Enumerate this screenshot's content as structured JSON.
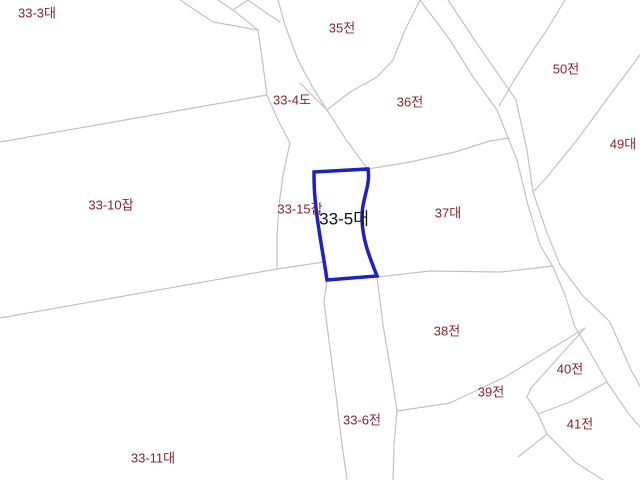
{
  "map": {
    "type": "cadastral-parcel-map",
    "canvas": {
      "width": 640,
      "height": 480
    },
    "colors": {
      "background": "#ffffff",
      "boundary_line": "#c2c2c2",
      "label_text": "#8a212e",
      "highlight_label_text": "#111111",
      "highlight_outline": "#1a1fd0"
    },
    "selected_parcel": {
      "label": "33-5대",
      "outline_path": "M 314 172 L 368 169 C 371 186 361 200 362 220 C 363 243 371 260 377 276 L 327 280 C 323 252 317 224 315 198 C 314 188 314 179 314 172 Z",
      "outline_width": 3.5
    },
    "labels": [
      {
        "id": "parcel-label-33-3",
        "text": "33-3대",
        "x": 37,
        "y": 12,
        "highlight": false
      },
      {
        "id": "parcel-label-35",
        "text": "35전",
        "x": 342,
        "y": 27,
        "highlight": false
      },
      {
        "id": "parcel-label-33-4",
        "text": "33-4도",
        "x": 292,
        "y": 99,
        "highlight": false
      },
      {
        "id": "parcel-label-36",
        "text": "36전",
        "x": 410,
        "y": 101,
        "highlight": false
      },
      {
        "id": "parcel-label-50",
        "text": "50전",
        "x": 566,
        "y": 68,
        "highlight": false
      },
      {
        "id": "parcel-label-49",
        "text": "49대",
        "x": 623,
        "y": 143,
        "highlight": false
      },
      {
        "id": "parcel-label-33-10",
        "text": "33-10잡",
        "x": 111,
        "y": 204,
        "highlight": false
      },
      {
        "id": "parcel-label-33-15",
        "text": "33-15잡",
        "x": 300,
        "y": 208,
        "highlight": false
      },
      {
        "id": "parcel-label-33-5",
        "text": "33-5대",
        "x": 344,
        "y": 217,
        "highlight": true
      },
      {
        "id": "parcel-label-37",
        "text": "37대",
        "x": 448,
        "y": 212,
        "highlight": false
      },
      {
        "id": "parcel-label-38",
        "text": "38전",
        "x": 447,
        "y": 330,
        "highlight": false
      },
      {
        "id": "parcel-label-39",
        "text": "39전",
        "x": 491,
        "y": 391,
        "highlight": false
      },
      {
        "id": "parcel-label-40",
        "text": "40전",
        "x": 570,
        "y": 368,
        "highlight": false
      },
      {
        "id": "parcel-label-41",
        "text": "41전",
        "x": 580,
        "y": 423,
        "highlight": false
      },
      {
        "id": "parcel-label-33-6",
        "text": "33-6전",
        "x": 362,
        "y": 419,
        "highlight": false
      },
      {
        "id": "parcel-label-33-11",
        "text": "33-11대",
        "x": 153,
        "y": 457,
        "highlight": false
      }
    ],
    "boundary_lines": [
      {
        "name": "topleft-branch",
        "points": [
          [
            180,
            0
          ],
          [
            213,
            22
          ],
          [
            258,
            30
          ]
        ]
      },
      {
        "name": "top-notch-v",
        "points": [
          [
            218,
            0
          ],
          [
            233,
            10
          ],
          [
            248,
            0
          ]
        ]
      },
      {
        "name": "top-notch-link",
        "points": [
          [
            233,
            10
          ],
          [
            258,
            30
          ]
        ]
      },
      {
        "name": "top-merge-link",
        "points": [
          [
            248,
            0
          ],
          [
            265,
            12
          ],
          [
            280,
            22
          ]
        ]
      },
      {
        "name": "road1-left-upper",
        "points": [
          [
            258,
            30
          ],
          [
            263,
            65
          ],
          [
            267,
            95
          ],
          [
            278,
            120
          ],
          [
            290,
            143
          ]
        ]
      },
      {
        "name": "road1-left-mid",
        "points": [
          [
            290,
            143
          ],
          [
            283,
            175
          ],
          [
            279,
            205
          ],
          [
            277,
            235
          ],
          [
            277,
            269
          ]
        ]
      },
      {
        "name": "west-long-upper",
        "points": [
          [
            0,
            142
          ],
          [
            267,
            95
          ]
        ]
      },
      {
        "name": "west-long-lower",
        "points": [
          [
            0,
            318
          ],
          [
            277,
            269
          ],
          [
            324,
            262
          ]
        ]
      },
      {
        "name": "road1-right-upper",
        "points": [
          [
            278,
            0
          ],
          [
            285,
            25
          ],
          [
            298,
            60
          ],
          [
            313,
            88
          ],
          [
            327,
            110
          ]
        ]
      },
      {
        "name": "road1-right-spur",
        "points": [
          [
            300,
            83
          ],
          [
            327,
            110
          ]
        ]
      },
      {
        "name": "road1-right-mid",
        "points": [
          [
            327,
            110
          ],
          [
            345,
            138
          ],
          [
            363,
            163
          ],
          [
            368,
            169
          ]
        ]
      },
      {
        "name": "b35-36",
        "points": [
          [
            420,
            0
          ],
          [
            405,
            30
          ],
          [
            393,
            60
          ],
          [
            377,
            77
          ],
          [
            350,
            92
          ],
          [
            327,
            110
          ]
        ]
      },
      {
        "name": "b36-37",
        "points": [
          [
            368,
            169
          ],
          [
            410,
            162
          ],
          [
            455,
            152
          ],
          [
            490,
            141
          ],
          [
            509,
            138
          ]
        ]
      },
      {
        "name": "road1-left-lower",
        "points": [
          [
            327,
            280
          ],
          [
            324,
            302
          ],
          [
            329,
            340
          ],
          [
            336,
            395
          ],
          [
            341,
            437
          ],
          [
            347,
            480
          ]
        ]
      },
      {
        "name": "road1-right-lower",
        "points": [
          [
            377,
            277
          ],
          [
            383,
            325
          ],
          [
            391,
            372
          ],
          [
            397,
            411
          ],
          [
            394,
            445
          ],
          [
            393,
            480
          ]
        ]
      },
      {
        "name": "b37-38",
        "points": [
          [
            377,
            277
          ],
          [
            430,
            271
          ],
          [
            501,
            272
          ],
          [
            553,
            266
          ]
        ]
      },
      {
        "name": "b38-39",
        "points": [
          [
            397,
            411
          ],
          [
            450,
            403
          ],
          [
            505,
            377
          ],
          [
            585,
            328
          ]
        ]
      },
      {
        "name": "b40-west",
        "points": [
          [
            585,
            328
          ],
          [
            531,
            388
          ],
          [
            527,
            397
          ],
          [
            538,
            414
          ]
        ]
      },
      {
        "name": "b40-41",
        "points": [
          [
            538,
            414
          ],
          [
            570,
            402
          ],
          [
            607,
            382
          ]
        ]
      },
      {
        "name": "b41-south",
        "points": [
          [
            538,
            414
          ],
          [
            547,
            434
          ],
          [
            575,
            462
          ],
          [
            603,
            480
          ]
        ]
      },
      {
        "name": "b41-southwest",
        "points": [
          [
            547,
            434
          ],
          [
            518,
            457
          ]
        ]
      },
      {
        "name": "road2-left",
        "points": [
          [
            420,
            0
          ],
          [
            450,
            40
          ],
          [
            473,
            77
          ],
          [
            497,
            110
          ],
          [
            517,
            160
          ],
          [
            528,
            205
          ],
          [
            540,
            245
          ],
          [
            553,
            267
          ],
          [
            565,
            295
          ],
          [
            575,
            327
          ],
          [
            590,
            352
          ],
          [
            607,
            382
          ],
          [
            628,
            413
          ],
          [
            640,
            427
          ]
        ]
      },
      {
        "name": "road2-right",
        "points": [
          [
            448,
            0
          ],
          [
            478,
            45
          ],
          [
            516,
            100
          ],
          [
            527,
            150
          ],
          [
            533,
            192
          ],
          [
            546,
            230
          ],
          [
            560,
            265
          ],
          [
            582,
            295
          ],
          [
            610,
            322
          ],
          [
            631,
            370
          ],
          [
            640,
            386
          ]
        ]
      },
      {
        "name": "b35-50",
        "points": [
          [
            565,
            0
          ],
          [
            548,
            28
          ],
          [
            530,
            55
          ],
          [
            513,
            82
          ],
          [
            499,
            106
          ]
        ]
      },
      {
        "name": "b50-49",
        "points": [
          [
            640,
            55
          ],
          [
            610,
            95
          ],
          [
            577,
            140
          ],
          [
            547,
            177
          ],
          [
            534,
            191
          ]
        ]
      }
    ]
  }
}
